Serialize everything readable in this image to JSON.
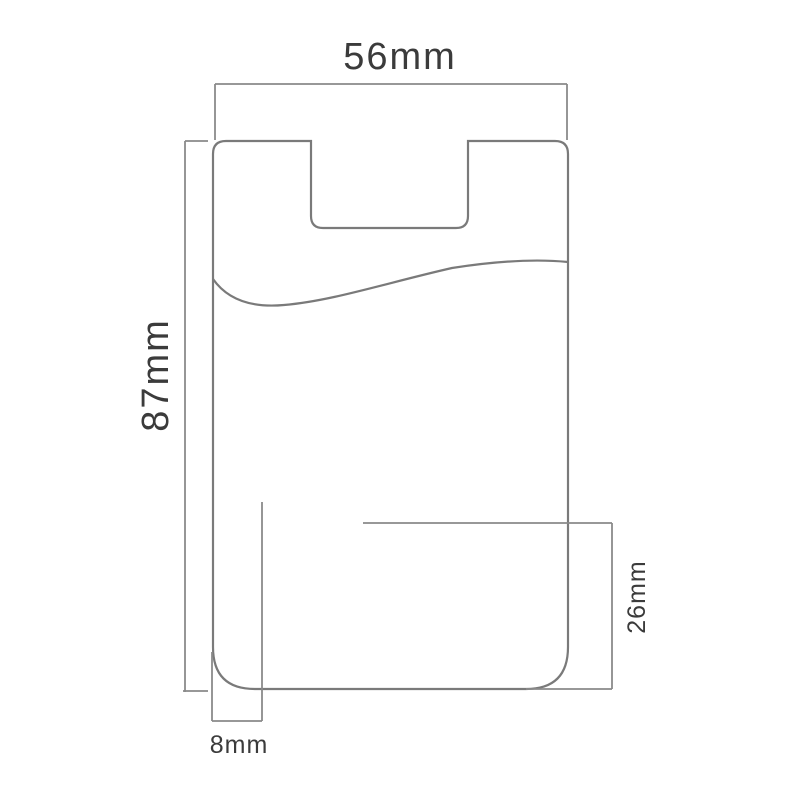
{
  "page": {
    "background_color": "#ffffff",
    "description": "Technical dimension drawing of a stick-on phone card holder sleeve with thumb notch and pocket opening curve"
  },
  "diagram": {
    "line_color": "#7a7a7a",
    "dimension_line_color": "#8a8a8a",
    "label_color": "#3b3b3b",
    "object_name": "card-holder-outline",
    "dimensions": {
      "width": {
        "label": "56mm",
        "value": 56,
        "unit": "mm",
        "position": "top"
      },
      "height": {
        "label": "87mm",
        "value": 87,
        "unit": "mm",
        "position": "left"
      },
      "bottom_inset": {
        "label": "8mm",
        "value": 8,
        "unit": "mm",
        "position": "bottom-left"
      },
      "pocket_height": {
        "label": "26mm",
        "value": 26,
        "unit": "mm",
        "position": "right"
      }
    }
  }
}
